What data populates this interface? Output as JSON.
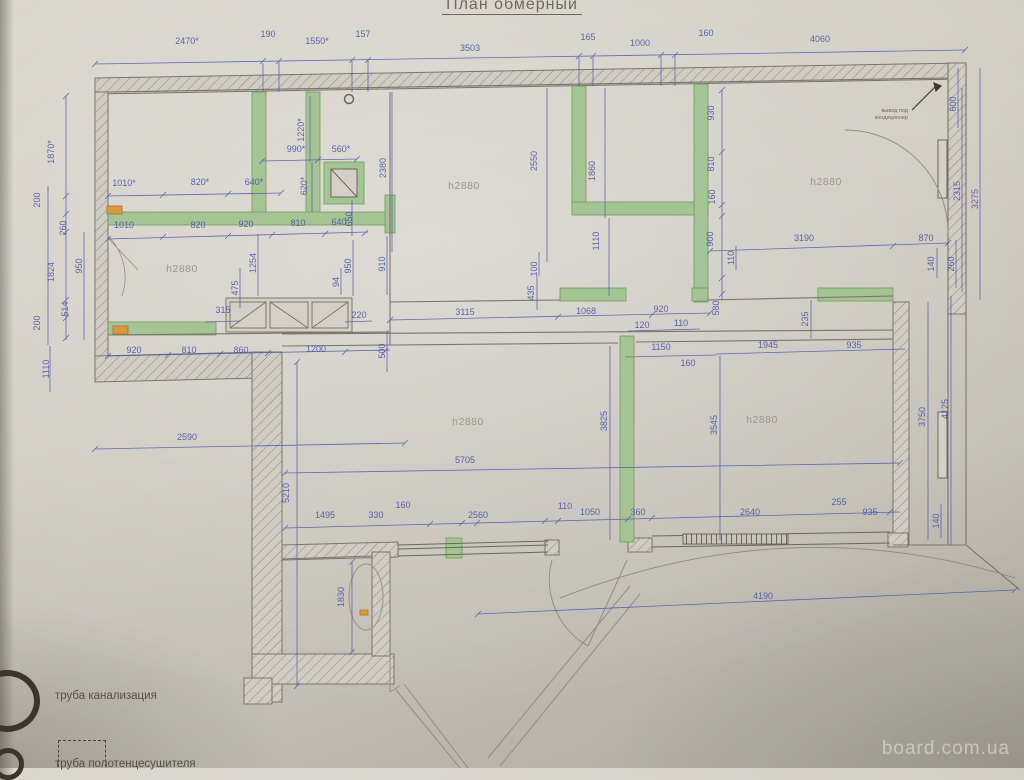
{
  "title": "План обмерный",
  "watermark": "board.com.ua",
  "legend": {
    "item1": "труба канализация",
    "item2": "труба полотенцесушителя"
  },
  "annotation": {
    "lines": [
      {
        "t": "вывод под",
        "x": 908,
        "y": 112,
        "r": 0
      },
      {
        "t": "кондиционер",
        "x": 908,
        "y": 119,
        "r": 0
      }
    ]
  },
  "room_labels": [
    {
      "t": "h2880",
      "x": 182,
      "y": 272
    },
    {
      "t": "h2880",
      "x": 464,
      "y": 189
    },
    {
      "t": "h2880",
      "x": 826,
      "y": 185
    },
    {
      "t": "h2880",
      "x": 468,
      "y": 425
    },
    {
      "t": "h2880",
      "x": 762,
      "y": 423
    }
  ],
  "dimensions": [
    {
      "t": "2470*",
      "x": 187,
      "y": 44,
      "r": 0
    },
    {
      "t": "190",
      "x": 268,
      "y": 37,
      "r": 0
    },
    {
      "t": "1550*",
      "x": 317,
      "y": 44,
      "r": 0
    },
    {
      "t": "157",
      "x": 363,
      "y": 37,
      "r": 0
    },
    {
      "t": "3503",
      "x": 470,
      "y": 51,
      "r": 0
    },
    {
      "t": "165",
      "x": 588,
      "y": 40,
      "r": 0
    },
    {
      "t": "1000",
      "x": 640,
      "y": 46,
      "r": 0
    },
    {
      "t": "160",
      "x": 706,
      "y": 36,
      "r": 0
    },
    {
      "t": "4060",
      "x": 820,
      "y": 42,
      "r": 0
    },
    {
      "t": "1870*",
      "x": 54,
      "y": 152,
      "r": -90
    },
    {
      "t": "200",
      "x": 40,
      "y": 200,
      "r": -90
    },
    {
      "t": "260",
      "x": 66,
      "y": 228,
      "r": -90
    },
    {
      "t": "1824",
      "x": 54,
      "y": 272,
      "r": -90
    },
    {
      "t": "950",
      "x": 82,
      "y": 266,
      "r": -90
    },
    {
      "t": "514",
      "x": 68,
      "y": 309,
      "r": -90
    },
    {
      "t": "200",
      "x": 40,
      "y": 323,
      "r": -90
    },
    {
      "t": "1110",
      "x": 49,
      "y": 369,
      "r": -90
    },
    {
      "t": "1010*",
      "x": 124,
      "y": 186,
      "r": 0
    },
    {
      "t": "820*",
      "x": 200,
      "y": 185,
      "r": 0
    },
    {
      "t": "640*",
      "x": 254,
      "y": 185,
      "r": 0
    },
    {
      "t": "1010",
      "x": 124,
      "y": 228,
      "r": 0
    },
    {
      "t": "820",
      "x": 198,
      "y": 228,
      "r": 0
    },
    {
      "t": "920",
      "x": 246,
      "y": 227,
      "r": 0
    },
    {
      "t": "810",
      "x": 298,
      "y": 226,
      "r": 0
    },
    {
      "t": "640",
      "x": 339,
      "y": 225,
      "r": 0
    },
    {
      "t": "990*",
      "x": 296,
      "y": 152,
      "r": 0
    },
    {
      "t": "560*",
      "x": 341,
      "y": 152,
      "r": 0
    },
    {
      "t": "1220*",
      "x": 304,
      "y": 130,
      "r": -90
    },
    {
      "t": "620*",
      "x": 307,
      "y": 186,
      "r": -90
    },
    {
      "t": "2380",
      "x": 386,
      "y": 168,
      "r": -90
    },
    {
      "t": "650",
      "x": 352,
      "y": 219,
      "r": -90
    },
    {
      "t": "1254",
      "x": 256,
      "y": 263,
      "r": -90
    },
    {
      "t": "475",
      "x": 238,
      "y": 288,
      "r": -90
    },
    {
      "t": "315",
      "x": 223,
      "y": 313,
      "r": 0
    },
    {
      "t": "950",
      "x": 351,
      "y": 266,
      "r": -90
    },
    {
      "t": "910",
      "x": 385,
      "y": 264,
      "r": -90
    },
    {
      "t": "94",
      "x": 339,
      "y": 282,
      "r": -90
    },
    {
      "t": "220",
      "x": 359,
      "y": 318,
      "r": 0
    },
    {
      "t": "920",
      "x": 134,
      "y": 353,
      "r": 0
    },
    {
      "t": "810",
      "x": 189,
      "y": 353,
      "r": 0
    },
    {
      "t": "860",
      "x": 241,
      "y": 353,
      "r": 0
    },
    {
      "t": "1200",
      "x": 316,
      "y": 352,
      "r": 0
    },
    {
      "t": "500",
      "x": 385,
      "y": 351,
      "r": -90
    },
    {
      "t": "3115",
      "x": 465,
      "y": 315,
      "r": 0
    },
    {
      "t": "1068",
      "x": 586,
      "y": 314,
      "r": 0
    },
    {
      "t": "435",
      "x": 534,
      "y": 293,
      "r": -90
    },
    {
      "t": "100",
      "x": 537,
      "y": 269,
      "r": -90
    },
    {
      "t": "920",
      "x": 661,
      "y": 312,
      "r": 0
    },
    {
      "t": "120",
      "x": 642,
      "y": 328,
      "r": 0
    },
    {
      "t": "110",
      "x": 681,
      "y": 326,
      "r": 0
    },
    {
      "t": "1150",
      "x": 661,
      "y": 350,
      "r": 0
    },
    {
      "t": "160",
      "x": 688,
      "y": 366,
      "r": 0
    },
    {
      "t": "580",
      "x": 719,
      "y": 308,
      "r": -90
    },
    {
      "t": "1945",
      "x": 768,
      "y": 348,
      "r": 0
    },
    {
      "t": "935",
      "x": 854,
      "y": 348,
      "r": 0
    },
    {
      "t": "2550",
      "x": 537,
      "y": 161,
      "r": -90
    },
    {
      "t": "1860",
      "x": 595,
      "y": 171,
      "r": -90
    },
    {
      "t": "1110",
      "x": 599,
      "y": 241,
      "r": -90
    },
    {
      "t": "930",
      "x": 714,
      "y": 113,
      "r": -90
    },
    {
      "t": "810",
      "x": 714,
      "y": 164,
      "r": -90
    },
    {
      "t": "160",
      "x": 715,
      "y": 197,
      "r": -90
    },
    {
      "t": "900",
      "x": 713,
      "y": 239,
      "r": -90
    },
    {
      "t": "110",
      "x": 734,
      "y": 258,
      "r": -90
    },
    {
      "t": "3190",
      "x": 804,
      "y": 241,
      "r": 0
    },
    {
      "t": "870",
      "x": 926,
      "y": 241,
      "r": 0
    },
    {
      "t": "600",
      "x": 956,
      "y": 104,
      "r": -90
    },
    {
      "t": "2315",
      "x": 960,
      "y": 191,
      "r": -90
    },
    {
      "t": "3275",
      "x": 978,
      "y": 199,
      "r": -90
    },
    {
      "t": "260",
      "x": 954,
      "y": 264,
      "r": -90
    },
    {
      "t": "140",
      "x": 934,
      "y": 264,
      "r": -90
    },
    {
      "t": "235",
      "x": 808,
      "y": 319,
      "r": -90
    },
    {
      "t": "3545",
      "x": 717,
      "y": 425,
      "r": -90
    },
    {
      "t": "3750",
      "x": 925,
      "y": 417,
      "r": -90
    },
    {
      "t": "4125",
      "x": 948,
      "y": 409,
      "r": -90
    },
    {
      "t": "3825",
      "x": 607,
      "y": 421,
      "r": -90
    },
    {
      "t": "140",
      "x": 939,
      "y": 521,
      "r": -90
    },
    {
      "t": "2590",
      "x": 187,
      "y": 440,
      "r": 0
    },
    {
      "t": "5210",
      "x": 289,
      "y": 493,
      "r": -90
    },
    {
      "t": "5705",
      "x": 465,
      "y": 463,
      "r": 0
    },
    {
      "t": "1495",
      "x": 325,
      "y": 518,
      "r": 0
    },
    {
      "t": "330",
      "x": 376,
      "y": 518,
      "r": 0
    },
    {
      "t": "160",
      "x": 403,
      "y": 508,
      "r": 0
    },
    {
      "t": "2560",
      "x": 478,
      "y": 518,
      "r": 0
    },
    {
      "t": "110",
      "x": 565,
      "y": 509,
      "r": 0
    },
    {
      "t": "1050",
      "x": 590,
      "y": 515,
      "r": 0
    },
    {
      "t": "360",
      "x": 638,
      "y": 515,
      "r": 0
    },
    {
      "t": "2640",
      "x": 750,
      "y": 515,
      "r": 0
    },
    {
      "t": "255",
      "x": 839,
      "y": 505,
      "r": 0
    },
    {
      "t": "935",
      "x": 870,
      "y": 515,
      "r": 0
    },
    {
      "t": "4190",
      "x": 763,
      "y": 599,
      "r": 0
    },
    {
      "t": "1830",
      "x": 344,
      "y": 597,
      "r": -90
    }
  ],
  "colors": {
    "paper": "#cdc9c0",
    "wall_line": "#76716a",
    "green_wall": "#a5c494",
    "dimension_blue": "#4d55a8",
    "marker_orange": "#d89a3e"
  }
}
